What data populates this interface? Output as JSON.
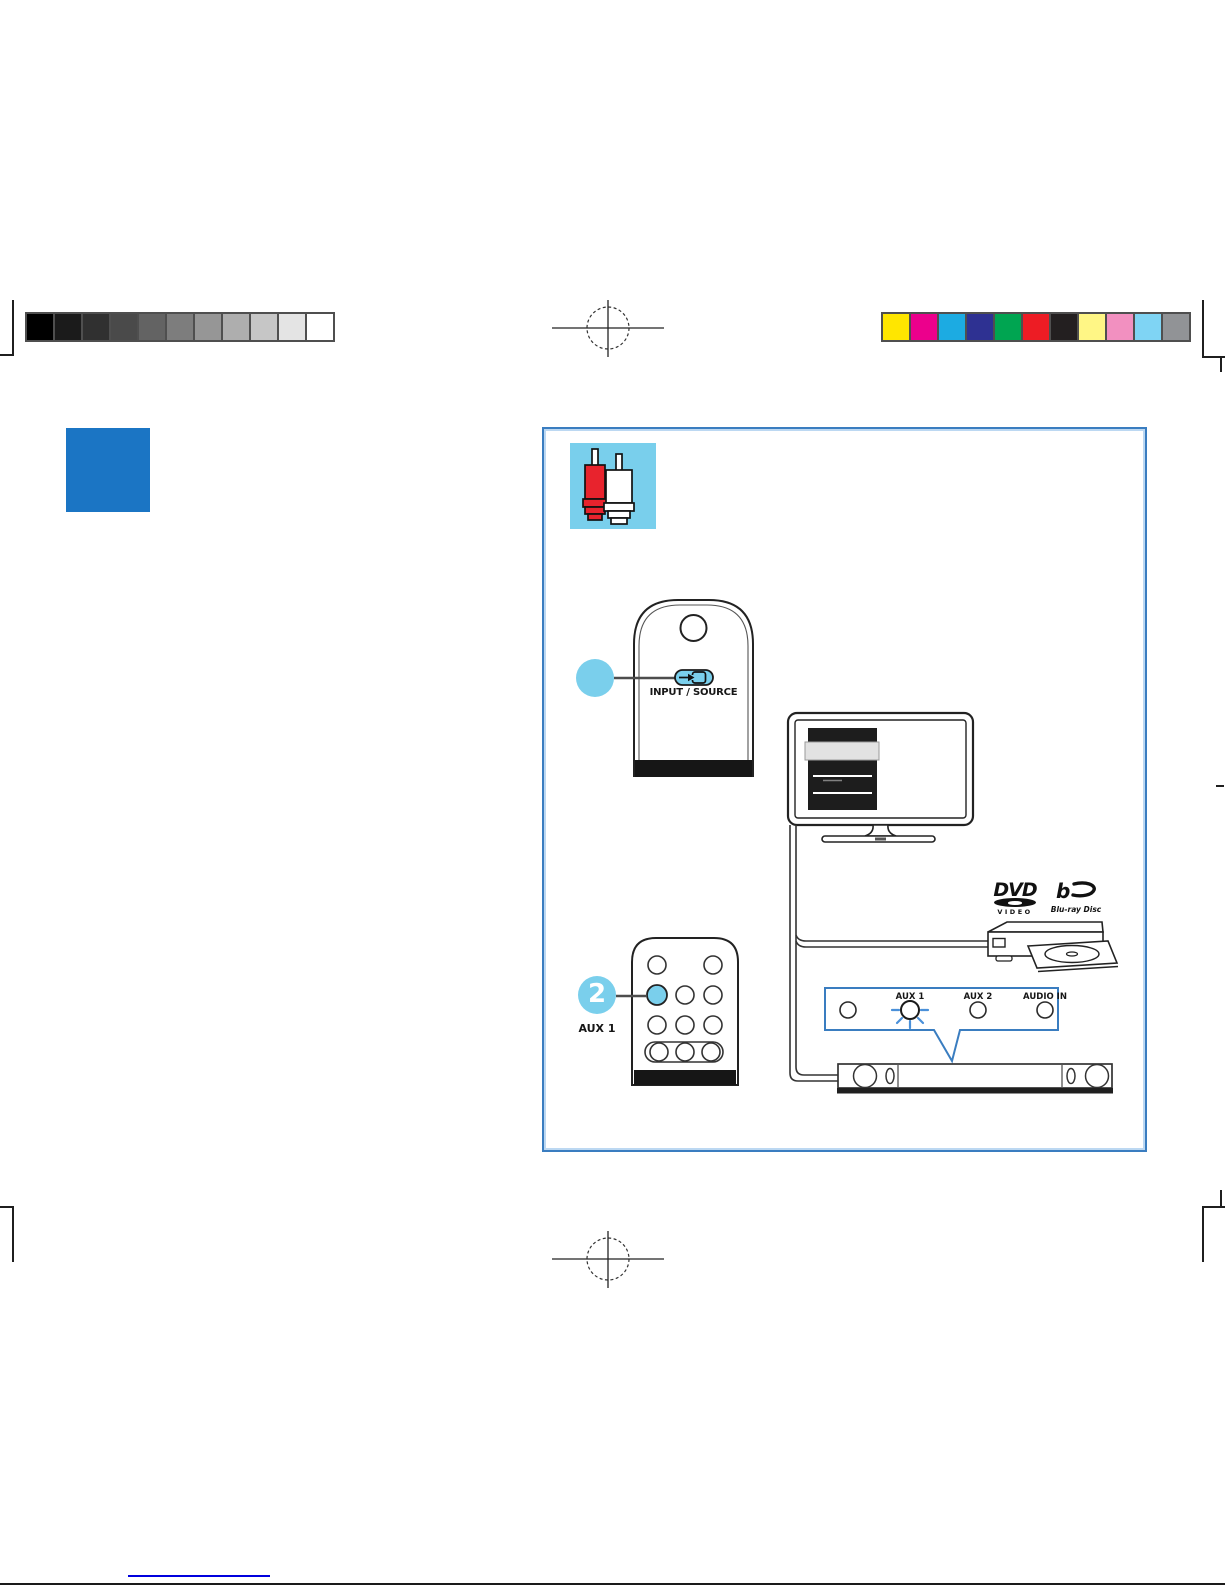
{
  "calibration": {
    "grayscale": [
      "#000000",
      "#1b1b1b",
      "#303030",
      "#4a4a4a",
      "#636363",
      "#7d7d7d",
      "#969696",
      "#aeaeae",
      "#c6c6c6",
      "#e4e4e4",
      "#ffffff"
    ],
    "colors": [
      "#ffe600",
      "#ec008c",
      "#1cabe2",
      "#2e3192",
      "#00a551",
      "#ed1c24",
      "#231f20",
      "#fff685",
      "#f290c0",
      "#7fd4f4",
      "#919396"
    ]
  },
  "chapter_tab": {
    "color": "#1b75c4"
  },
  "diagram": {
    "border_color": "#3a7dc0",
    "callout_color": "#7acfec",
    "remote_source": {
      "button_label": "INPUT / SOURCE"
    },
    "step_aux": {
      "number": "2",
      "label": "AUX 1"
    },
    "aux_panel": {
      "labels": [
        "AUX 1",
        "AUX 2",
        "AUDIO IN"
      ],
      "glow_color": "#4a90d9"
    },
    "dvd_logo": {
      "title": "DVD",
      "subtitle": "VIDEO"
    },
    "bluray_logo": {
      "label": "Blu-ray Disc"
    }
  },
  "footer": {
    "link_color": "#0000dd"
  }
}
